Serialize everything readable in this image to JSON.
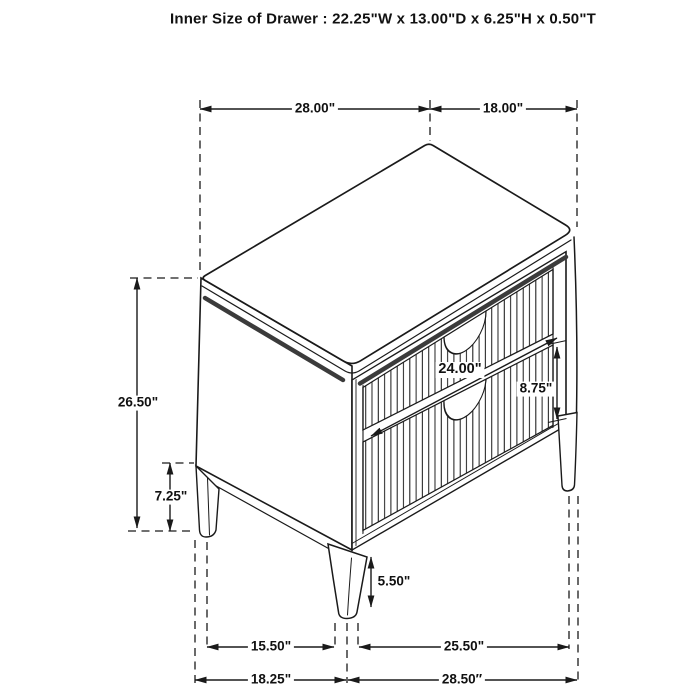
{
  "title": "Inner Size of Drawer : 22.25\"W x 13.00\"D x 6.25\"H x 0.50\"T",
  "figure": {
    "name": "two-drawer nightstand perspective line drawing",
    "drawer_count": 2,
    "features": "fluted drawer fronts, half-moon finger pulls, tapered legs"
  },
  "dimensions": {
    "top_width": "28.00\"",
    "top_depth": "18.00\"",
    "overall_height": "26.50\"",
    "underside_clearance": "7.25\"",
    "drawer_front_width": "24.00\"",
    "drawer_front_height": "8.75\"",
    "leg_height": "5.50\"",
    "leg_span_side": "15.50\"",
    "leg_span_front": "25.50\"",
    "base_depth": "18.25\"",
    "base_width": "28.50″"
  },
  "colors": {
    "line": "#1a1a1a",
    "background": "#ffffff",
    "groove_stripe": "#3b3b3b"
  }
}
